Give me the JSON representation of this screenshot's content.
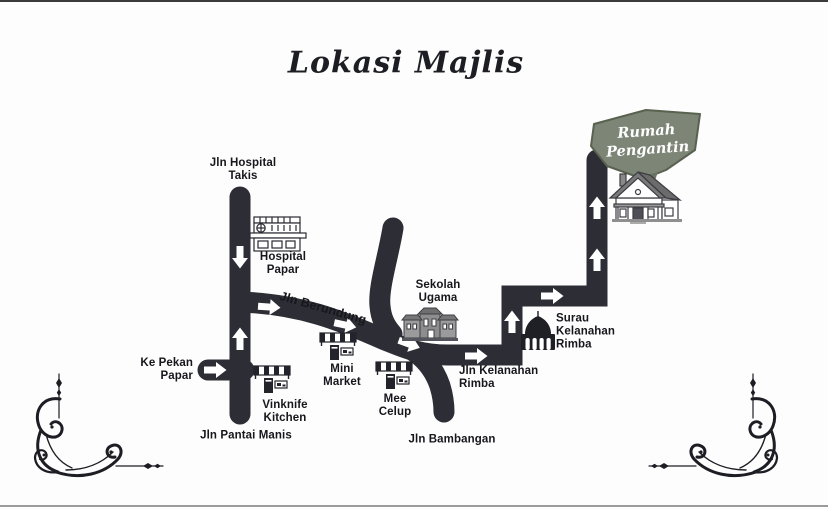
{
  "title": "Lokasi Majlis",
  "map": {
    "roads": {
      "jln_hospital_takis": "Jln Hospital\nTakis",
      "jln_berundung": "Jln Berundung",
      "jln_pantai_manis": "Jln Pantai Manis",
      "jln_bambangan": "Jln Bambangan",
      "jln_kelanahan_rimba": "Jln Kelanahan\nRimba",
      "ke_pekan_papar": "Ke Pekan\nPapar"
    },
    "places": {
      "hospital_papar": "Hospital\nPapar",
      "sekolah_ugama": "Sekolah\nUgama",
      "surau_kelanahan_rimba": "Surau\nKelanahan\nRimba",
      "vinknife_kitchen": "Vinknife\nKitchen",
      "mini_market": "Mini\nMarket",
      "mee_celup": "Mee\nCelup",
      "rumah_pengantin": "Rumah\nPengantin"
    },
    "icons": {
      "hospital": "hospital-building-icon",
      "shop": "shop-awning-icon",
      "school": "school-building-icon",
      "mosque": "mosque-icon",
      "house": "house-icon",
      "banner": "ribbon-banner",
      "flourish": "corner-flourish-ornament",
      "arrow": "route-direction-arrow"
    },
    "colors": {
      "road": "#2d2d35",
      "label": "#16161c",
      "banner": "#7d8577",
      "page": "#fdfdfd"
    }
  }
}
